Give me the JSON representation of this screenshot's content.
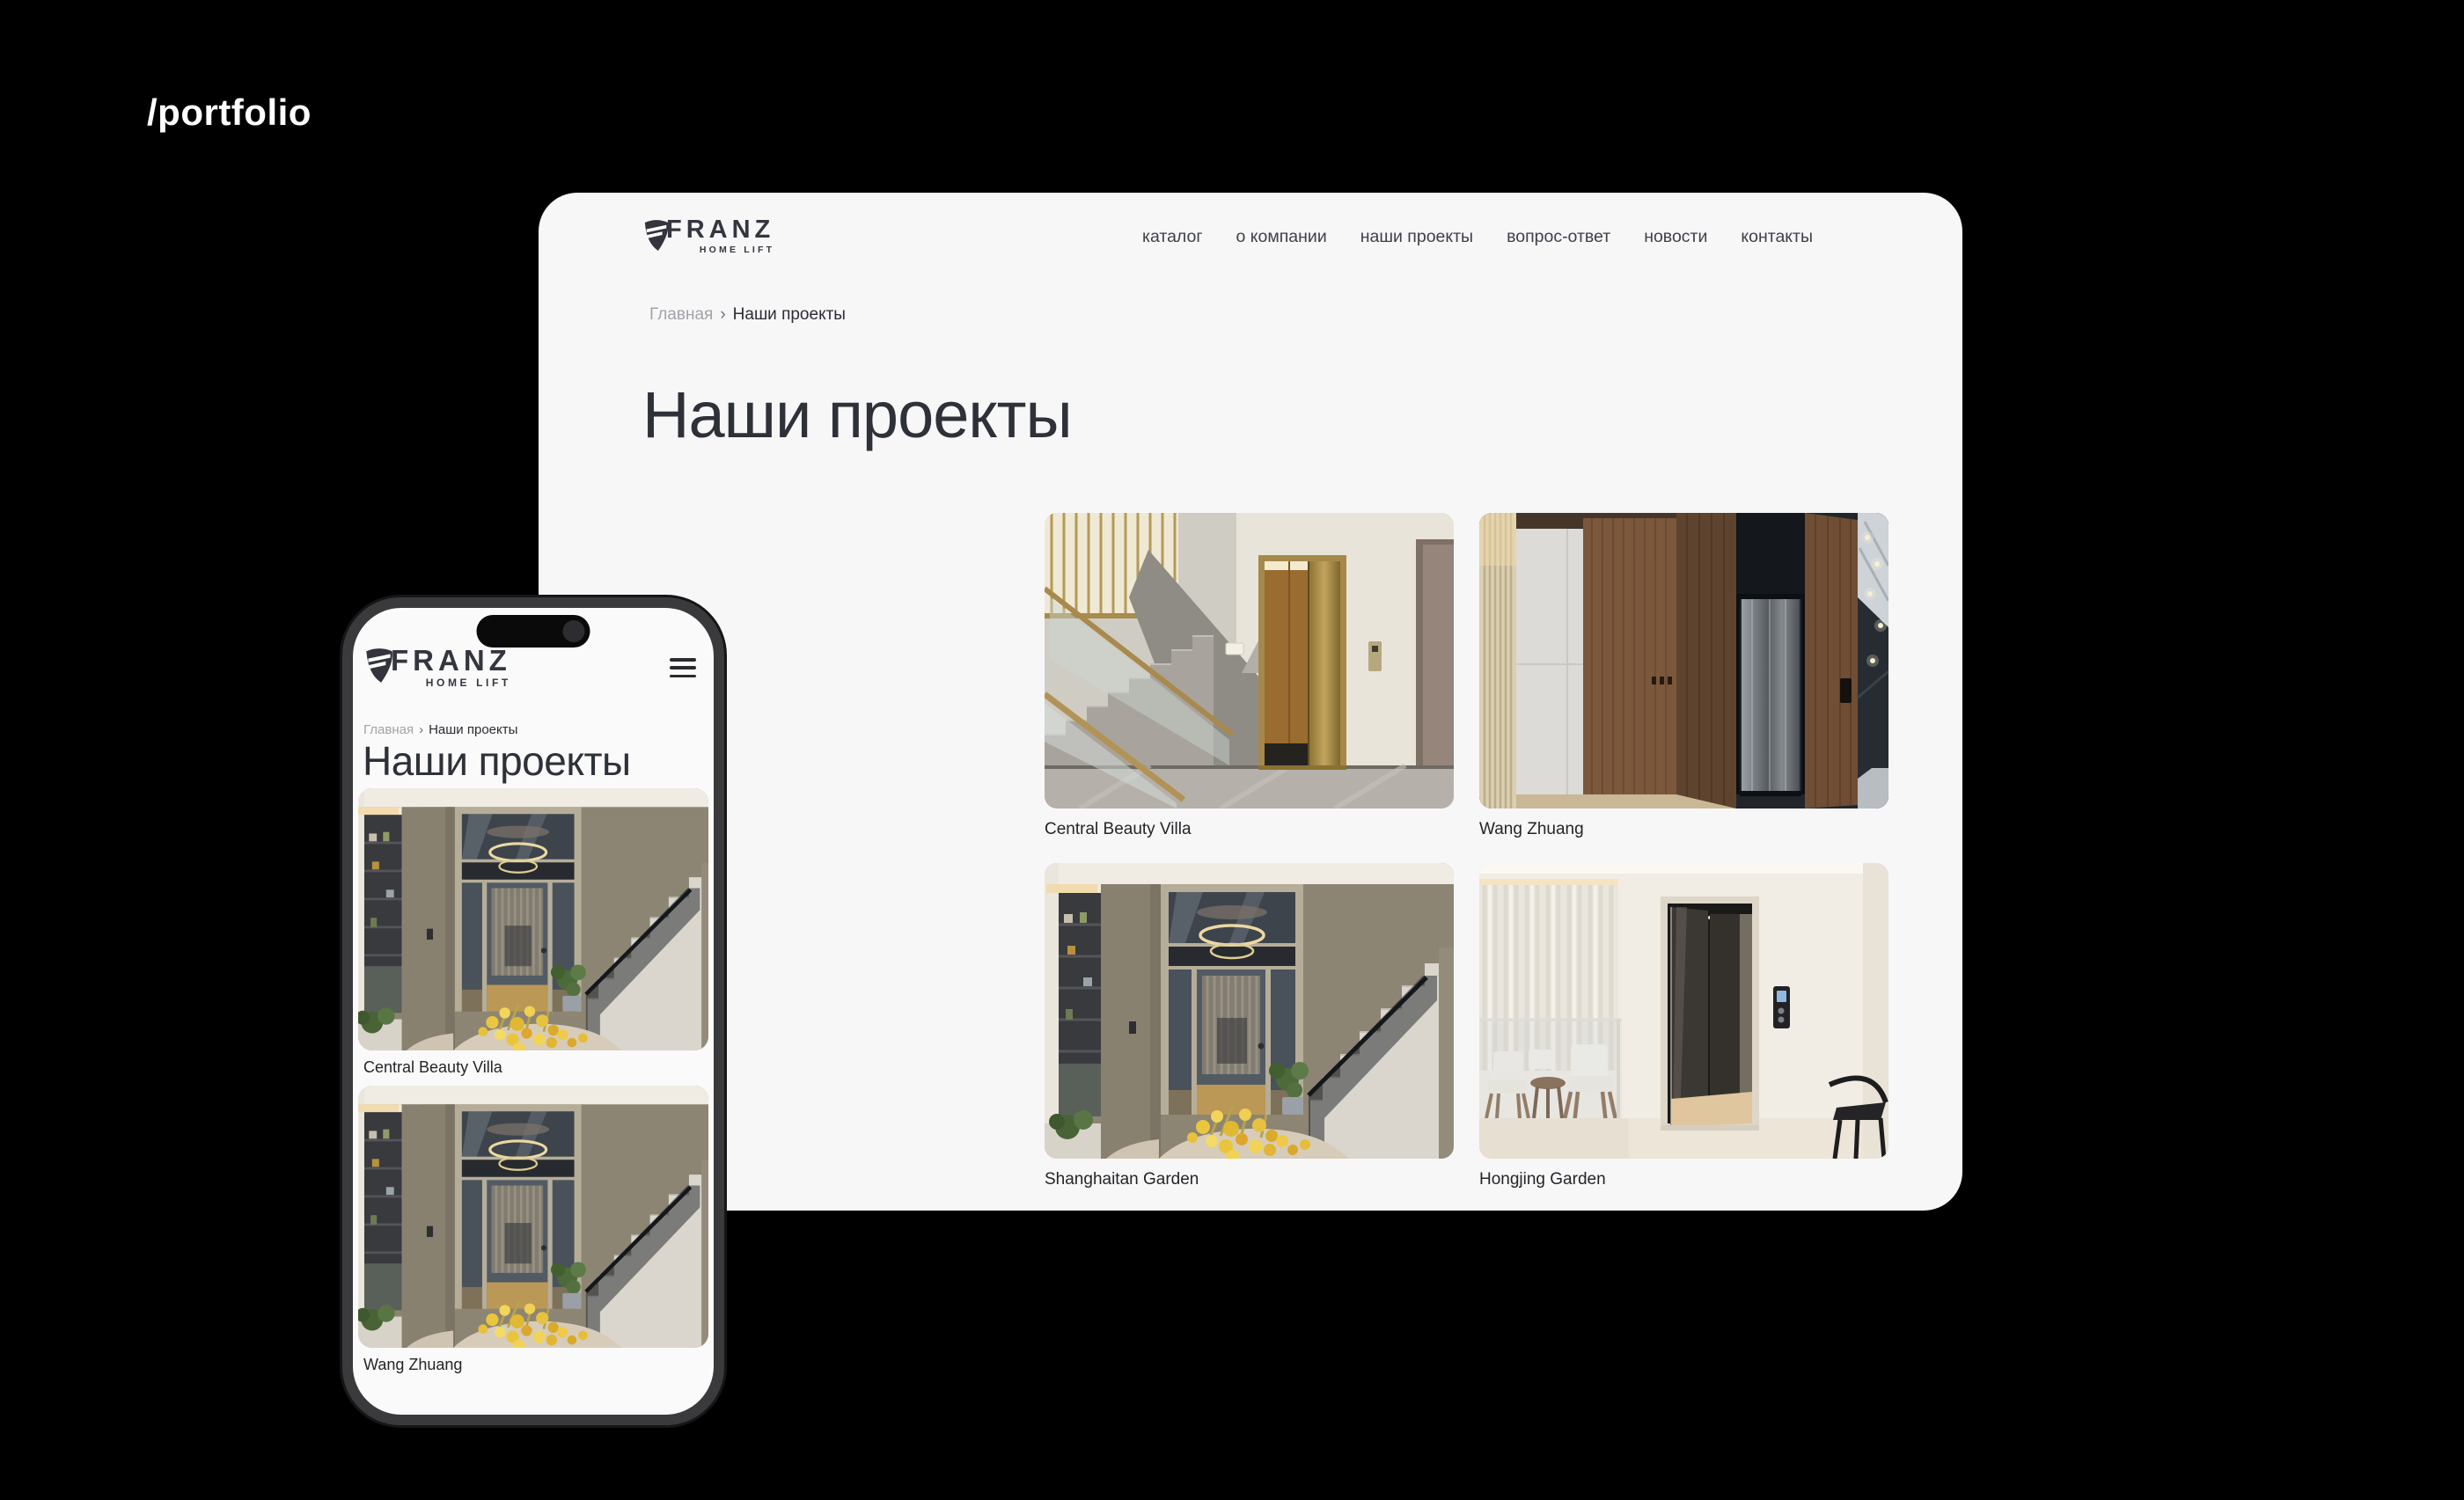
{
  "overlay_label": "/portfolio",
  "brand": {
    "name": "FRANZ",
    "tagline": "HOME LIFT"
  },
  "desktop_site": {
    "nav_items": [
      "каталог",
      "о компании",
      "наши проекты",
      "вопрос-ответ",
      "новости",
      "контакты"
    ],
    "breadcrumb": {
      "home": "Главная",
      "separator": "›",
      "current": "Наши проекты"
    },
    "page_title": "Наши проекты",
    "projects": [
      {
        "caption": "Central Beauty Villa"
      },
      {
        "caption": "Wang Zhuang"
      },
      {
        "caption": "Shanghaitan Garden"
      },
      {
        "caption": "Hongjing Garden"
      }
    ]
  },
  "mobile_site": {
    "breadcrumb": {
      "home": "Главная",
      "separator": "›",
      "current": "Наши проекты"
    },
    "page_title": "Наши проекты",
    "projects": [
      {
        "caption": "Central Beauty Villa"
      },
      {
        "caption": "Wang Zhuang"
      }
    ]
  },
  "colors": {
    "background": "#000000",
    "surface": "#f7f7f8",
    "text_primary": "#2e3138",
    "text_muted": "#a3a3a8",
    "logo": "#34363f"
  }
}
